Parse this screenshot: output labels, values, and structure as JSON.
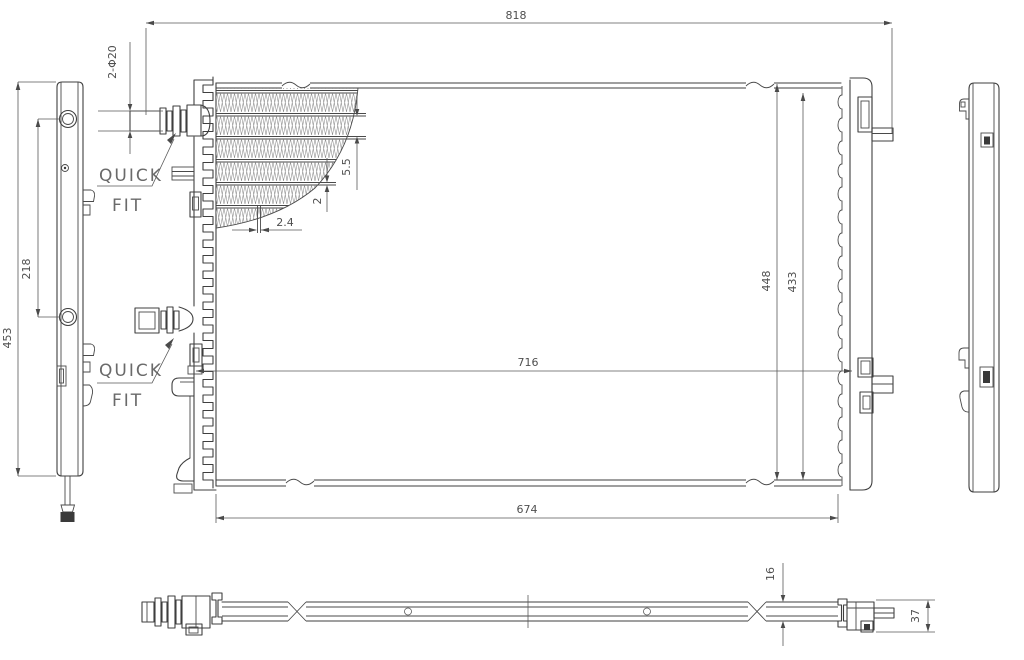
{
  "drawing": {
    "type": "radiator engineering drawing, 4 orthographic views with core fin detail",
    "colors": {
      "line": "#3f3f3f",
      "dim_line": "#5a5a5a",
      "text": "#4f4f4f",
      "callout_text": "#6a6a6a",
      "dark_fill": "#3a3a3a",
      "background": "#ffffff"
    },
    "dims": {
      "overall_width": "818",
      "mid_width": "716",
      "core_width": "674",
      "height_outer": "448",
      "height_inner": "433",
      "side_height": "453",
      "port_spacing": "218",
      "port_note": "2-Φ20",
      "fin_height": "5.5",
      "tube_height": "2",
      "tube_width": "2.4",
      "core_thickness": "16",
      "end_depth": "37"
    },
    "callouts": {
      "upper": {
        "word1": "QUICK",
        "word2": "FIT"
      },
      "lower": {
        "word1": "QUICK",
        "word2": "FIT"
      }
    }
  }
}
